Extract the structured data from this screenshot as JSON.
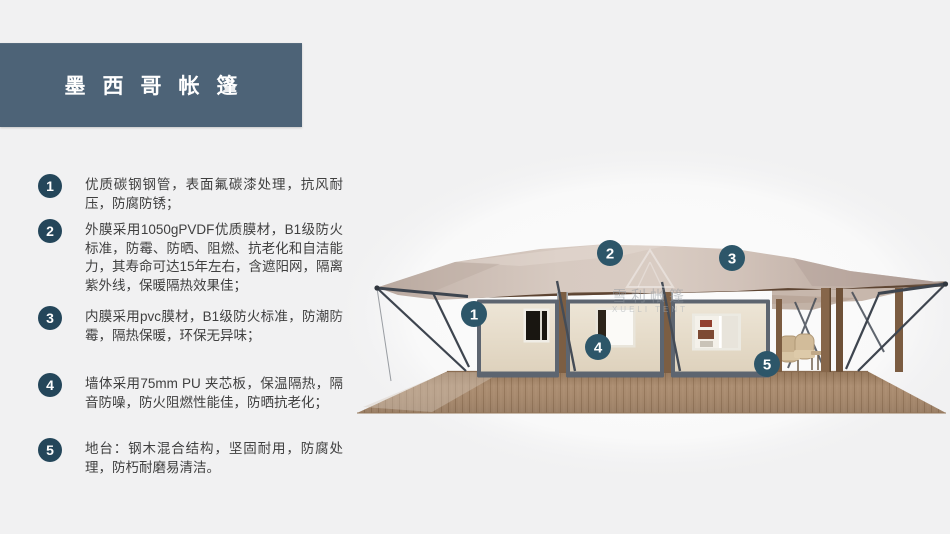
{
  "title": {
    "text": "墨西哥帐篷"
  },
  "features": [
    {
      "num": "1",
      "text": "优质碳钢钢管，表面氟碳漆处理，抗风耐压，防腐防锈；"
    },
    {
      "num": "2",
      "text": "外膜采用1050gPVDF优质膜材，B1级防火标准，防霉、防晒、阻燃、抗老化和自洁能力，其寿命可达15年左右，含遮阳网，隔离紫外线，保暖隔热效果佳；"
    },
    {
      "num": "3",
      "text": "内膜采用pvc膜材，B1级防火标准，防潮防霉，隔热保暖，环保无异味；"
    },
    {
      "num": "4",
      "text": "墙体采用75mm PU 夹芯板，保温隔热，隔音防噪，防火阻燃性能佳，防晒抗老化；"
    },
    {
      "num": "5",
      "text": "地台：钢木混合结构，坚固耐用，防腐处理，防朽耐磨易清洁。"
    }
  ],
  "colors": {
    "page_bg": "#f1f1f2",
    "banner_bg": "#4d6377",
    "bullet_bg": "#24465a",
    "callout_bg": "#2d5669",
    "text": "#3f3f3f",
    "roof": "#d2c4bb",
    "wall": "#e9e0cf",
    "wood": "#6b5340",
    "deck": "#ab8d71",
    "steel": "#3e454f"
  },
  "illustration": {
    "watermark": {
      "cn": "雪利帐篷",
      "en": "XUELI TENT"
    },
    "callouts": [
      {
        "num": "1",
        "x": 474,
        "y": 314
      },
      {
        "num": "2",
        "x": 610,
        "y": 253
      },
      {
        "num": "3",
        "x": 732,
        "y": 258
      },
      {
        "num": "4",
        "x": 598,
        "y": 347
      },
      {
        "num": "5",
        "x": 767,
        "y": 364
      }
    ]
  }
}
